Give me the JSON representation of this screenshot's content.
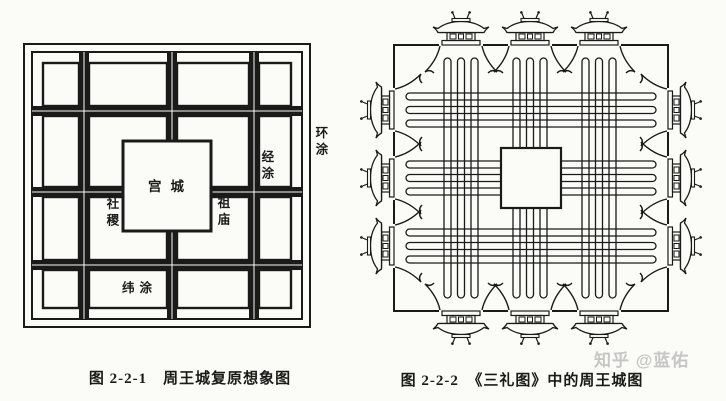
{
  "colors": {
    "ink": "#1a1a18",
    "paper": "#fbfbf8",
    "watermark": "#c6c6c4"
  },
  "left_figure": {
    "caption": "图 2-2-1　周王城复原想象图",
    "labels": {
      "palace_city": "宫城",
      "sheji_altar": "社稷",
      "ancestral_temple": "祖庙",
      "jing_tu_road": "经涂",
      "huan_tu_road": "环涂",
      "wei_tu_road": "纬涂"
    }
  },
  "right_figure": {
    "caption": "图 2-2-2　《三礼图》中的周王城图"
  },
  "watermark_text": "知乎 @蓝佑"
}
